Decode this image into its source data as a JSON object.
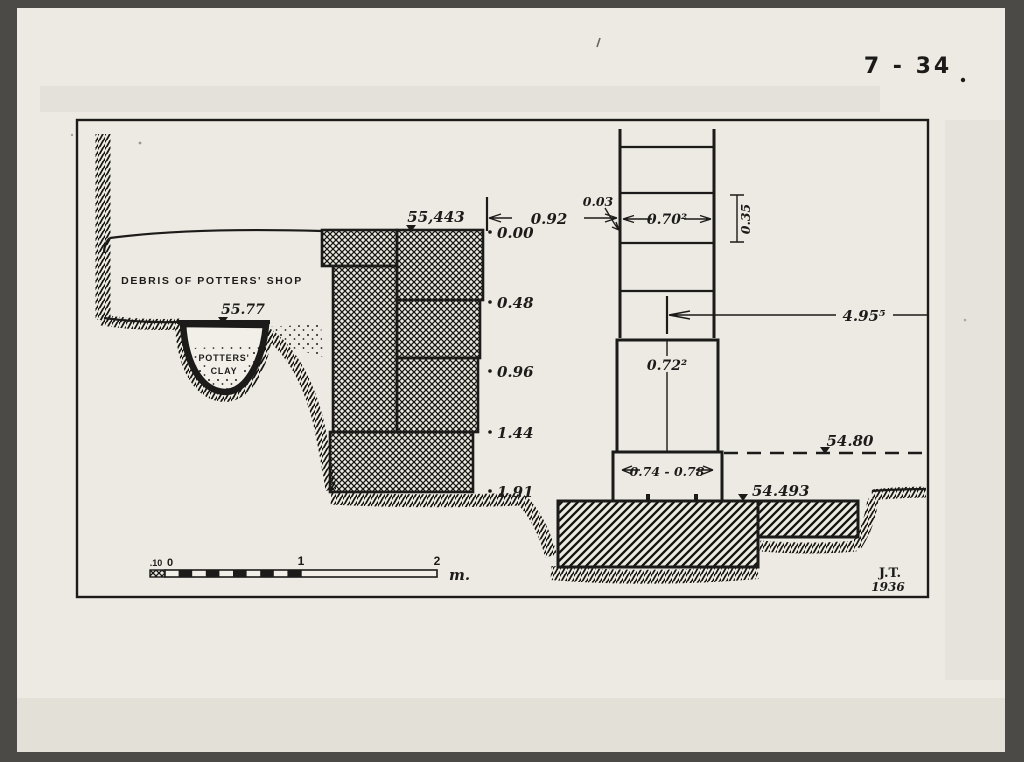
{
  "page": {
    "figure_number": "7 - 34",
    "type": "archaeological section drawing"
  },
  "colors": {
    "background": "#4b4a46",
    "paper": "#edeae3",
    "ink": "#1c1b19"
  },
  "drawing": {
    "labels": {
      "debris": "DEBRIS OF POTTERS' SHOP",
      "potters_line1": "POTTERS'",
      "potters_line2": "CLAY"
    },
    "elevations": {
      "surface_pit": "55.77",
      "wall_top": "55,443",
      "dashed_level": "54.80",
      "foundation_top": "54.493"
    },
    "depth_marks": [
      "0.00",
      "0.48",
      "0.96",
      "1.44",
      "1.91"
    ],
    "dimensions": {
      "wall_to_column": "0.92",
      "edge_offset": "0.03",
      "shaft_width": "0.70²",
      "drum_height": "0.35",
      "column_ref_length": "4.95⁵",
      "plinth_width": "0.72²",
      "base_width": "0.74 - 0.78"
    },
    "scale_bar": {
      "sub_label": ".10",
      "zero": "0",
      "one": "1",
      "two": "2",
      "unit": "m."
    },
    "signature": {
      "initials": "J.T.",
      "year": "1936"
    }
  }
}
